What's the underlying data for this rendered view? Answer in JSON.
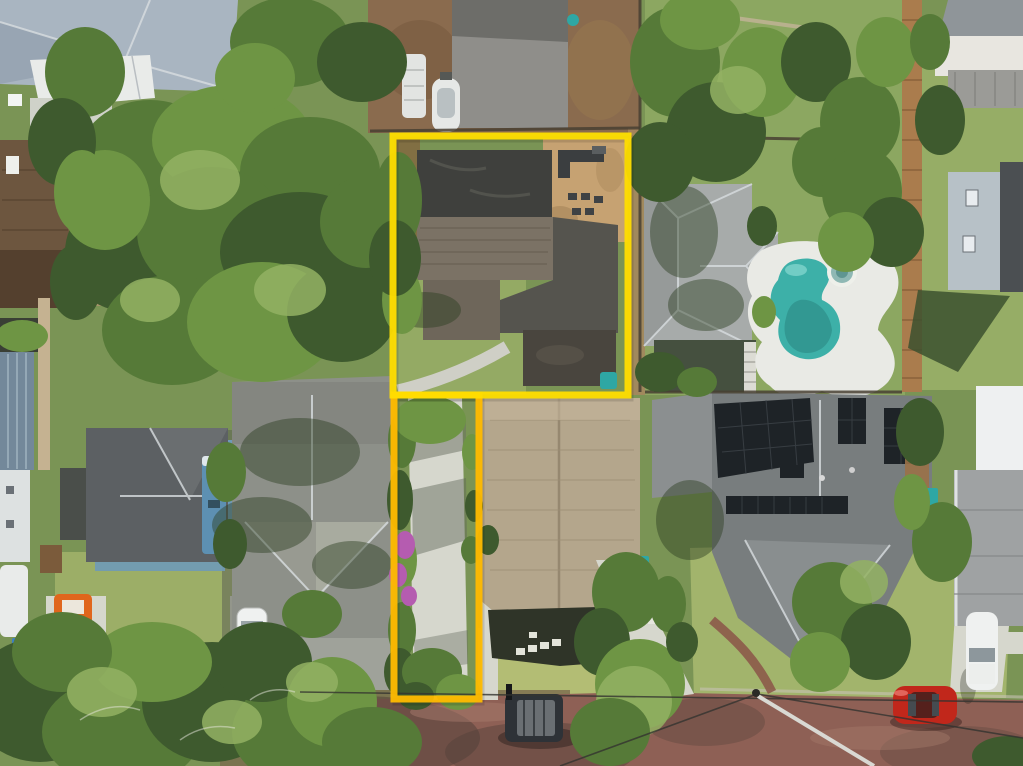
{
  "image": {
    "kind": "aerial-drone-photograph",
    "subject": "residential neighborhood with a flag-shaped lot outlined in yellow",
    "width_px": 1023,
    "height_px": 766,
    "text_content": "none - photograph contains no visible text"
  },
  "overlay": {
    "type": "property-boundary-outline",
    "shape": "flag lot: main parcel plus narrow driveway strip running south to the street",
    "main_parcel_px": {
      "x": 393,
      "y": 136,
      "width": 235,
      "height": 259
    },
    "flag_strip_px": {
      "x": 394,
      "y": 395,
      "width": 85,
      "height": 304
    },
    "stroke_width_px": 7
  },
  "colors": {
    "boundary_main": "#FFDD00",
    "boundary_strip": "#FFBB00",
    "grass_base": "#7a9455",
    "grass_light": "#9ab06c",
    "lawn_sunlit": "#b3bd74",
    "street_brick": "#8e6055",
    "street_shadow": "#53413a",
    "concrete": "#d6d7cd",
    "dirt": "#8a6b4e",
    "patio_sand": "#c6a272",
    "pool_water": "#3db0a8",
    "pool_water_deep": "#2c8c85",
    "pool_deck": "#e9eae5",
    "subject_roof_flat": "#3f403d",
    "subject_roof_shingle": "#7b7265",
    "tan_roof": "#b4a68c",
    "pool_house_roof": "#a7abaa",
    "solar_roof": "#787d7e",
    "solar_panel": "#1e2327",
    "left_house_roof": "#8d9089",
    "cottage_roof": "#5c6063",
    "topleft_roof": "#a9b5c1",
    "brown_roof": "#6d563f",
    "wood_fence": "#aa7c4d",
    "red_car": "#c1271b",
    "dark_jeep": "#2e3237",
    "white_car": "#eff1f0",
    "orange_forklift": "#e0661c",
    "teal_bin": "#2ea7a4",
    "blue_bin": "#3c7fc4",
    "bougainvillea": "#b55cb0",
    "blue_trailer": "#5d90b2"
  },
  "scene": {
    "outlined_property": {
      "house": "single-story house with dark flat roof section, weathered shingle section and dark rear patio slab",
      "backyard_patio": "sandy patio with dark outdoor furniture, upper-right of parcel",
      "lawn": "green lawn lower-left of parcel with curved concrete walkway",
      "driveway_strip": "long concrete driveway bordered by shrubs and purple bougainvillea leading to street"
    },
    "neighbors": [
      {
        "name": "pool-house",
        "desc": "light gray hip-roof house with kidney-shaped teal pool, white deck and round spa",
        "bbox": [
          628,
          150,
          915,
          400
        ]
      },
      {
        "name": "solar-house",
        "desc": "large gray-roof house covered with dark solar panel arrays, brick front path",
        "bbox": [
          650,
          385,
          935,
          700
        ]
      },
      {
        "name": "tan-roof-house",
        "desc": "beige/tan shingle gable roof house right of the driveway strip",
        "bbox": [
          478,
          395,
          660,
          700
        ]
      },
      {
        "name": "left-gray-house",
        "desc": "gray shingle roof house with south-facing gable, white car in driveway",
        "bbox": [
          215,
          375,
          395,
          715
        ]
      },
      {
        "name": "blue-cottage",
        "desc": "dark-roof cottage with light blue walls",
        "bbox": [
          55,
          425,
          235,
          575
        ]
      },
      {
        "name": "top-left-house",
        "desc": "large blue-gray shingle roof with white patio cover panels",
        "bbox": [
          0,
          0,
          238,
          130
        ]
      },
      {
        "name": "brown-roof-house",
        "desc": "dark brown shingle roof house on left edge",
        "bbox": [
          0,
          140,
          80,
          310
        ]
      },
      {
        "name": "blue-metal-roof-house",
        "desc": "standing-seam blue-gray metal roof with white RV behind",
        "bbox": [
          0,
          350,
          36,
          640
        ]
      },
      {
        "name": "top-right-house",
        "desc": "white house with gray roof and metal awning, top right corner",
        "bbox": [
          935,
          0,
          1023,
          110
        ]
      },
      {
        "name": "right-two-story-house",
        "desc": "two-story light-sided house on right edge casting long shadow",
        "bbox": [
          945,
          160,
          1023,
          380
        ]
      },
      {
        "name": "right-white-building",
        "desc": "white building and gray roofs along lower right edge",
        "bbox": [
          950,
          385,
          1023,
          630
        ]
      }
    ],
    "vehicles": [
      {
        "name": "dark-jeep",
        "desc": "dark SUV/jeep parked on brick street",
        "bbox": [
          505,
          692,
          565,
          744
        ]
      },
      {
        "name": "red-car",
        "desc": "red sedan parked on street lower right",
        "bbox": [
          893,
          686,
          957,
          726
        ]
      },
      {
        "name": "white-car-left",
        "desc": "white car in left house driveway",
        "bbox": [
          237,
          608,
          267,
          674
        ]
      },
      {
        "name": "white-car-right",
        "desc": "white car in right-edge driveway",
        "bbox": [
          966,
          612,
          998,
          690
        ]
      },
      {
        "name": "orange-forklift",
        "desc": "orange forklift/tractor on far-left driveway",
        "bbox": [
          54,
          592,
          92,
          664
        ]
      },
      {
        "name": "boat-on-trailer",
        "desc": "white boat on trailer in dirt yard above outlined lot",
        "bbox": [
          432,
          76,
          460,
          134
        ]
      },
      {
        "name": "white-rv",
        "desc": "white RV/camper top of frame",
        "bbox": [
          402,
          54,
          426,
          118
        ]
      }
    ],
    "street": "red-brick paved street across the bottom with power lines, utility pole and guy pole",
    "vegetation": "dense oak canopy upper-left and lower-left, palms near street, shrubs along driveway strip"
  }
}
